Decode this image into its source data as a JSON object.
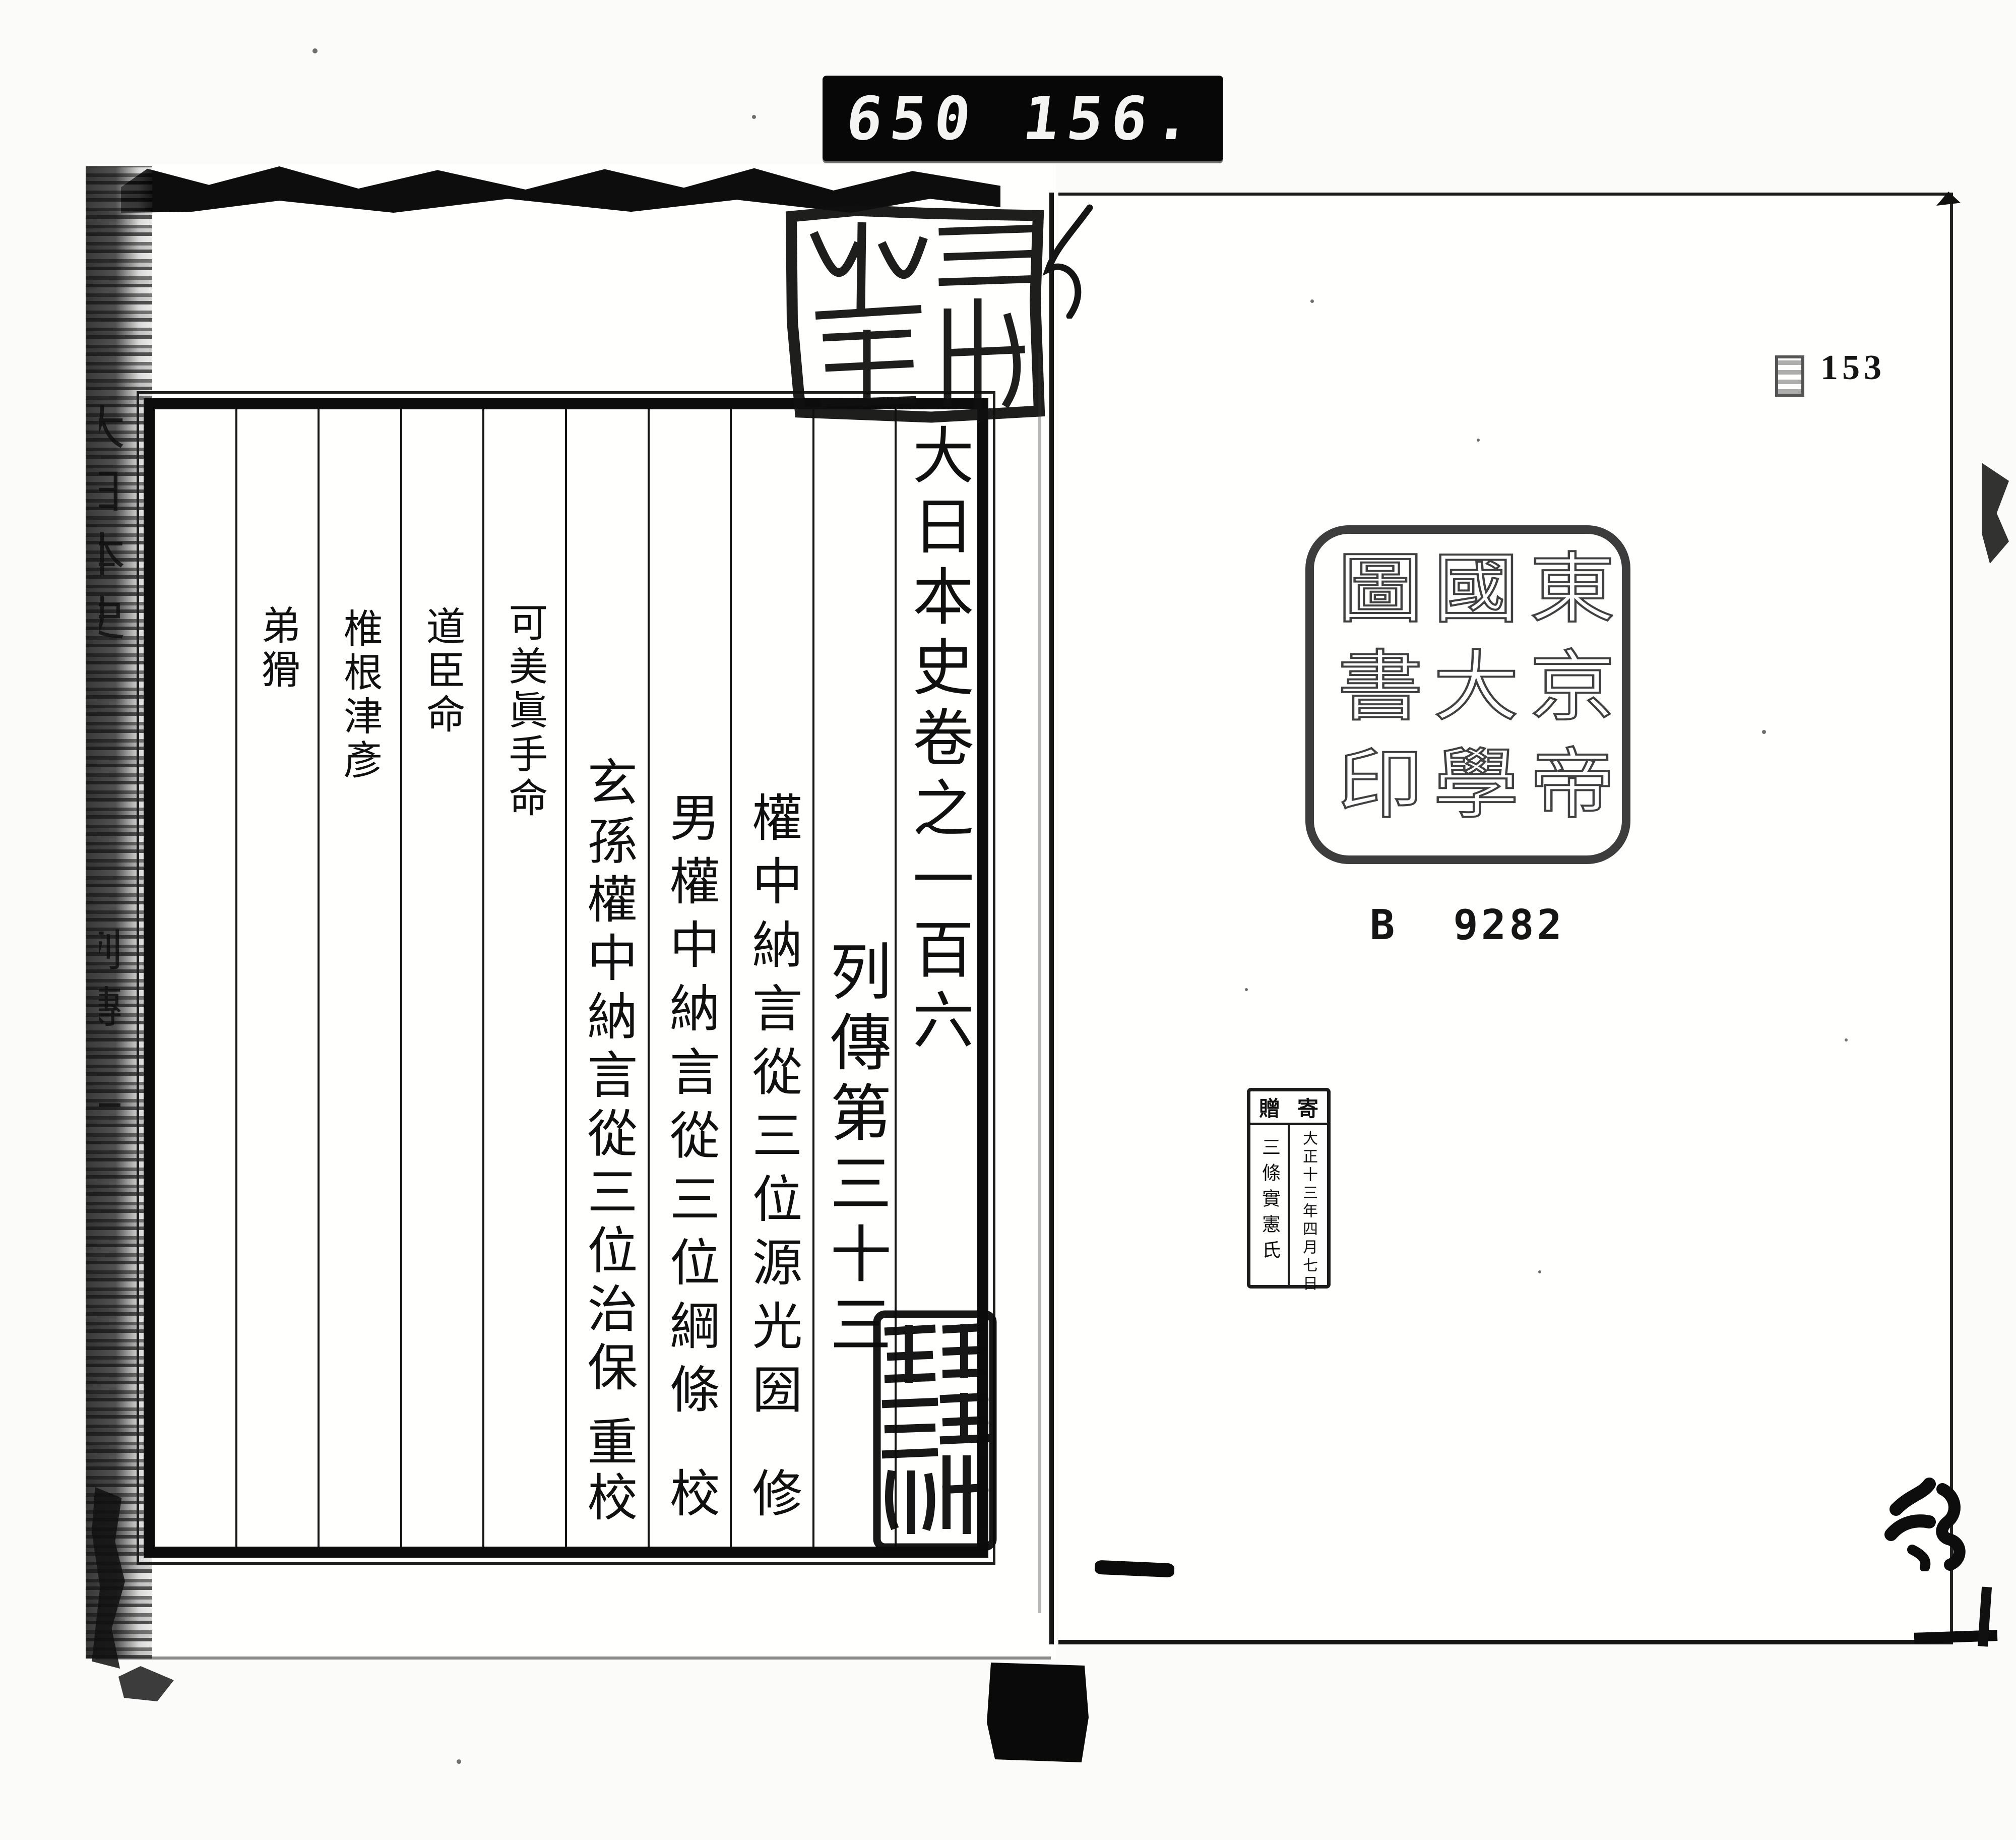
{
  "film_counter": {
    "left_value": "650",
    "right_value": "156."
  },
  "left_page": {
    "spine_fragments": [
      "大日本史",
      "列傳",
      "一"
    ],
    "frame": {
      "title": "大日本史卷之一百六",
      "section_heading": "列傳第三十三",
      "editors": [
        {
          "text": "權中納言從三位源光圀",
          "suffix": "修"
        },
        {
          "text": "男權中納言從三位綱條",
          "suffix": "校"
        },
        {
          "text": "玄孫權中納言從三位治保",
          "suffix": "重校"
        }
      ],
      "subjects": [
        "可美眞手命",
        "道臣命",
        "椎根津彥",
        "弟猾"
      ]
    }
  },
  "right_page": {
    "page_number": "153",
    "library_seal_columns": [
      "東京帝",
      "國大學",
      "圖書印"
    ],
    "call_number": {
      "prefix": "B",
      "number": "9282"
    },
    "donation_stamp": {
      "header_chars": [
        "寄",
        "贈"
      ],
      "date": "大正十三年四月七日",
      "donor": "三條實憲氏"
    }
  }
}
